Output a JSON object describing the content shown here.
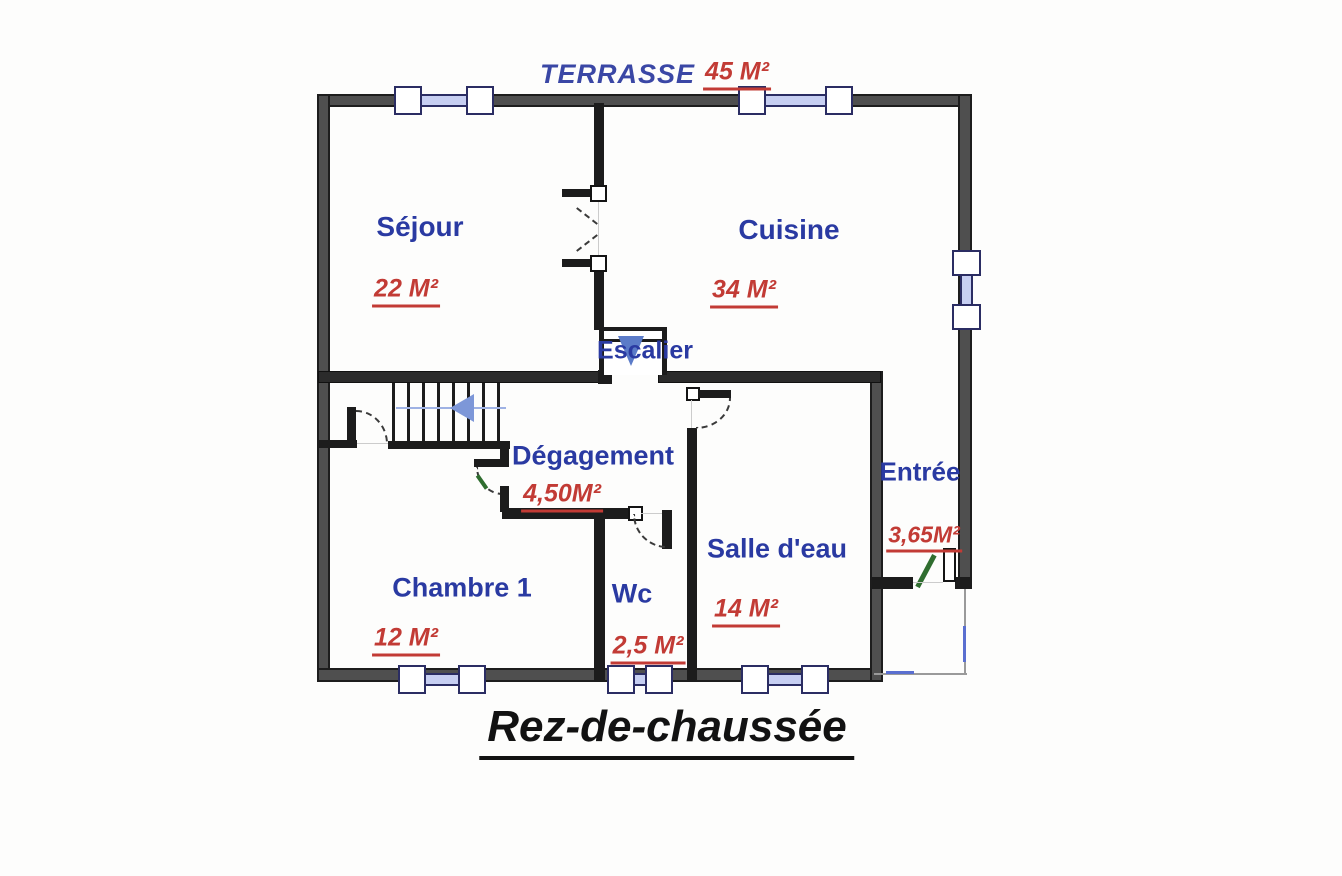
{
  "plan_title": "Rez-de-chaussée",
  "terrace": {
    "label": "TERRASSE",
    "area": "45 M²"
  },
  "rooms": {
    "sejour": {
      "label": "Séjour",
      "area": "22 M²"
    },
    "cuisine": {
      "label": "Cuisine",
      "area": "34 M²"
    },
    "escalier": {
      "label": "Escalier"
    },
    "degagement": {
      "label": "Dégagement",
      "area": "4,50M²"
    },
    "entree": {
      "label": "Entrée",
      "area": "3,65M²"
    },
    "chambre1": {
      "label": "Chambre 1",
      "area": "12 M²"
    },
    "wc": {
      "label": "Wc",
      "area": "2,5 M²"
    },
    "salle_deau": {
      "label": "Salle d'eau",
      "area": "14 M²"
    }
  },
  "colors": {
    "room_label": "#2a3aa2",
    "area_label": "#c23b35",
    "terrace_label": "#3a47a5",
    "wall_outer": "#4f4f4f",
    "wall_inner": "#1c1c1c",
    "window_frame": "#2b2d63",
    "window_glass": "#c7cff2",
    "stair_arrow": "#7d97d8",
    "entry_door": "#2f6d2f",
    "title": "#121212"
  }
}
